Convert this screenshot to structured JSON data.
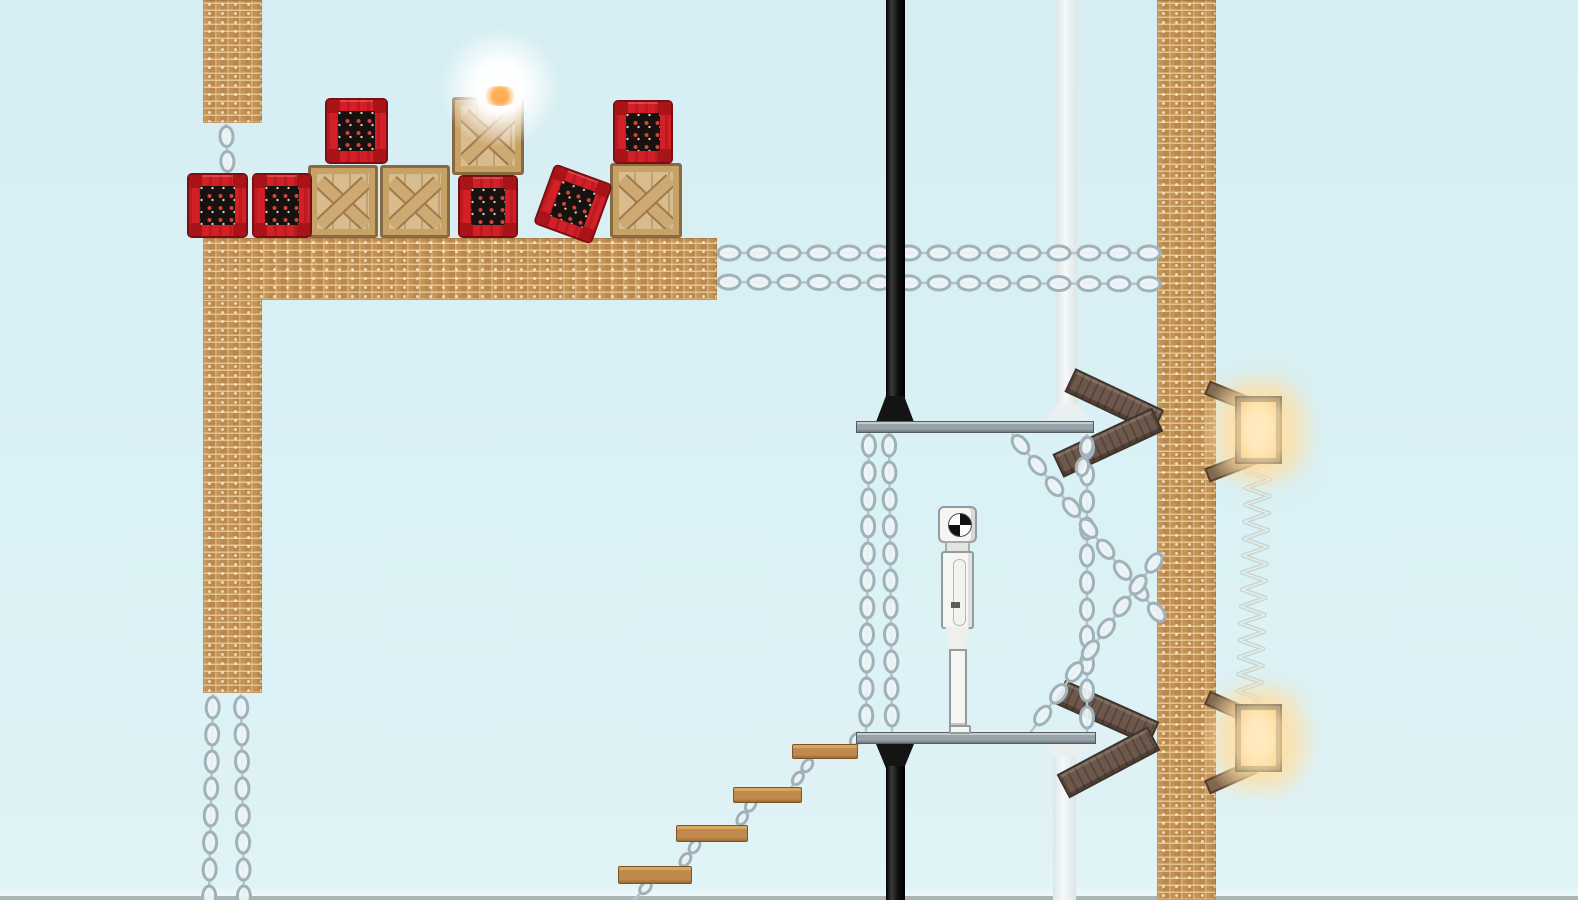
{
  "scene": {
    "label": "2D physics sandbox level",
    "background_color": "#d9f0f5"
  },
  "objects": {
    "brick_structure": {
      "label": "brick structure",
      "color": "#c29257"
    },
    "wooden_crate": {
      "label": "wooden crate",
      "color": "#d9bc8e",
      "visible_count": 4
    },
    "dynamite_crate": {
      "label": "dynamite crate",
      "color": "#d31f26",
      "visible_count": 6
    },
    "metal_platform": {
      "label": "metal platform",
      "color": "#98a3a9",
      "visible_count": 2
    },
    "black_pole": {
      "label": "black pole",
      "color": "#151515",
      "visible_count": 2
    },
    "white_pipe": {
      "label": "white pipe",
      "color": "#e9efef",
      "visible_count": 2
    },
    "chain": {
      "label": "chain",
      "color": "#9fb2ba"
    },
    "test_dummy": {
      "label": "test dummy",
      "color": "#f4f4f1",
      "visible_count": 1
    },
    "wall_lamp": {
      "label": "glowing wall lamp",
      "glow_color": "#ffd9a0",
      "visible_count": 2
    },
    "spring": {
      "label": "spring coil",
      "color": "#c7d8d4",
      "visible_count": 1
    },
    "wooden_chevron": {
      "label": "wooden chevron bracket",
      "color": "#6d584b",
      "visible_count": 2
    },
    "stair_plank": {
      "label": "hanging plank step",
      "color": "#c08a4d",
      "visible_count": 4
    },
    "light_glow": {
      "label": "white light glow"
    }
  }
}
